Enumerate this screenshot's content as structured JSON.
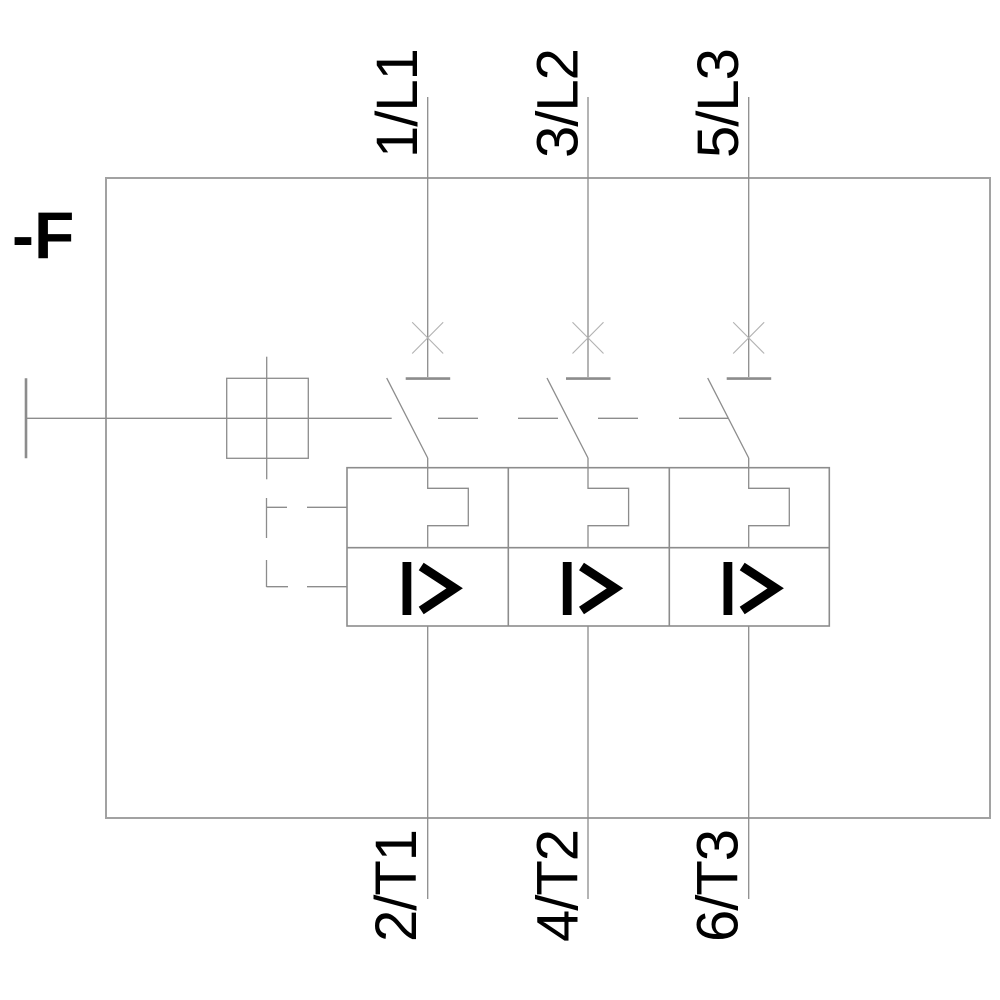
{
  "device": {
    "designation": "-F",
    "type_hint": "three-pole motor protection circuit breaker schematic"
  },
  "terminals": {
    "top": [
      "1/L1",
      "3/L2",
      "5/L3"
    ],
    "bottom": [
      "2/T1",
      "4/T2",
      "6/T3"
    ]
  },
  "symbols": {
    "magnetic_trip": "I>",
    "thermal_trip": "thermal-overload-hook",
    "breaker_function": "X"
  },
  "colors": {
    "background": "#ffffff",
    "line": "#8c8c8c",
    "line_light": "#b2b2b2",
    "frame": "#a2a2a2",
    "text": "#000000",
    "symbol": "#000000"
  }
}
